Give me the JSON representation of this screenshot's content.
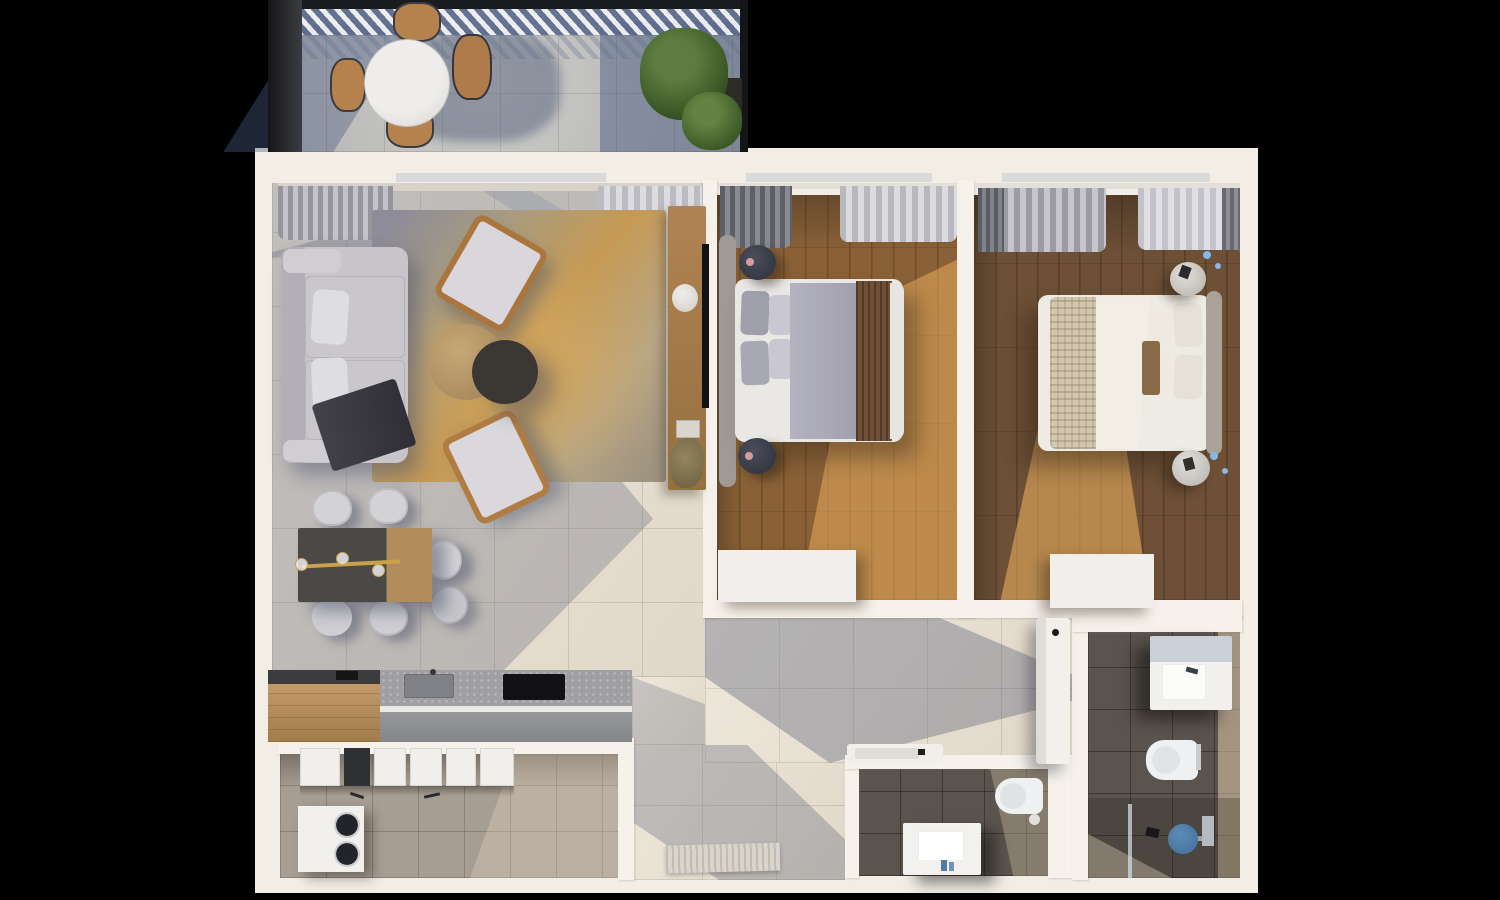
{
  "scene": {
    "type": "3d-floor-plan-render",
    "description": "Top-down dollhouse render of a two-bedroom apartment with terrace, no visible text",
    "background_color": "#000000"
  },
  "palette": {
    "background": "#000000",
    "outer_wall": "#f2eee6",
    "inner_wall": "#f6f2eb",
    "living_floor_tile": "#e9e1d1",
    "terrace_tile": "#b6b5b3",
    "bedroom1_wood": "#8a6137",
    "bedroom2_wood": "#6d5036",
    "sunlit_wood": "#e9b25f",
    "bathroom_tile": "#5b544e",
    "kitchen_tile": "#a79e93",
    "rug_gold": "#c69a54",
    "sofa_gray": "#c7c5c9",
    "shadow_blue": "#5a5f78",
    "shower_head_blue": "#4a7fa8",
    "pergola_shadow_blue": "#5a6e92",
    "shrub_green": "#3c5a26",
    "wood_furniture": "#a97f4f",
    "brass_accent": "#c8a24a"
  },
  "rooms": [
    {
      "id": "terrace",
      "label": "terrace",
      "items": [
        "pergola",
        "round-marble-table",
        "four-outdoor-chairs",
        "shrubs"
      ]
    },
    {
      "id": "living-room",
      "label": "living-room",
      "items": [
        "corner-sofa",
        "area-rug",
        "two-armchairs",
        "nesting-coffee-tables",
        "media-console",
        "wall-tv",
        "curtains"
      ]
    },
    {
      "id": "dining-area",
      "label": "dining-area",
      "items": [
        "dining-table",
        "six-chairs",
        "brass-pendant"
      ]
    },
    {
      "id": "kitchen",
      "label": "kitchen",
      "items": [
        "island-counter",
        "cooktop",
        "sink",
        "upper-cabinets",
        "washer-dryer"
      ]
    },
    {
      "id": "entry-hall",
      "label": "entry-hall",
      "items": [
        "doormat"
      ]
    },
    {
      "id": "hallway",
      "label": "hallway",
      "items": [
        "hall-bathtub-niche"
      ]
    },
    {
      "id": "bedroom-1",
      "label": "bedroom-1",
      "items": [
        "double-bed",
        "two-round-nightstands",
        "dresser",
        "curtains"
      ]
    },
    {
      "id": "bedroom-2",
      "label": "bedroom-2",
      "items": [
        "double-bed",
        "two-marble-side-tables",
        "dresser",
        "curtains"
      ]
    },
    {
      "id": "bathroom-1",
      "label": "bathroom-1",
      "items": [
        "vanity-sink",
        "wall-hung-toilet",
        "walk-in-shower",
        "glass-screen"
      ]
    },
    {
      "id": "bathroom-2",
      "label": "bathroom-2",
      "items": [
        "bathtub",
        "vanity-sink",
        "wall-hung-toilet"
      ]
    }
  ]
}
